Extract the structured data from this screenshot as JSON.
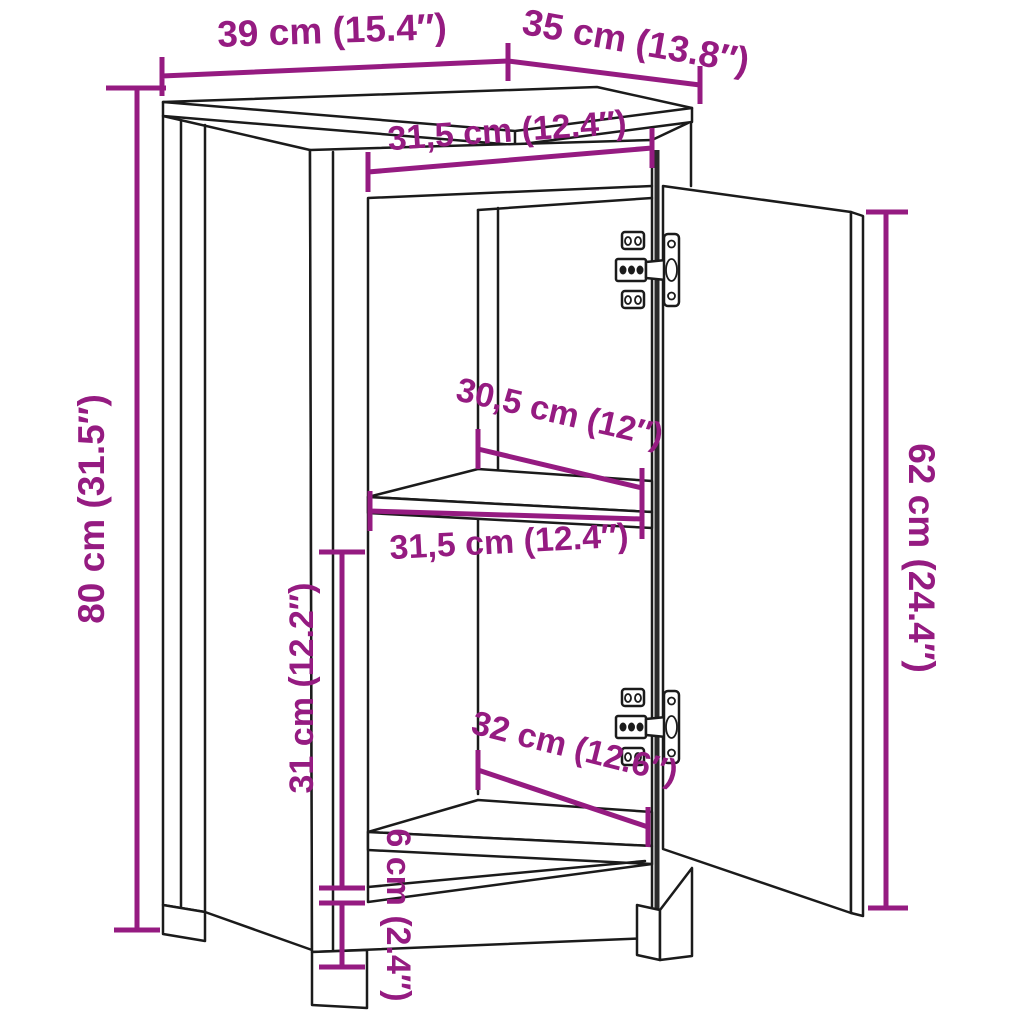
{
  "title": "Cabinet dimensions diagram",
  "diagram": {
    "type": "furniture-dimension-diagram",
    "subject": "two-compartment cabinet with open right-hand door and concealed hinges",
    "colors": {
      "accent": "#951B81",
      "outline": "#1B1B1B",
      "background": "#FFFFFF"
    },
    "dimensions": [
      {
        "id": "top-width",
        "label": "39 cm (15.4″)"
      },
      {
        "id": "top-depth",
        "label": "35 cm (13.8″)"
      },
      {
        "id": "inner-width-top",
        "label": "31,5 cm (12.4″)"
      },
      {
        "id": "total-height",
        "label": "80 cm (31.5″)"
      },
      {
        "id": "shelf-depth",
        "label": "30,5 cm (12″)"
      },
      {
        "id": "inner-width-middle",
        "label": "31,5 cm (12.4″)"
      },
      {
        "id": "door-height",
        "label": "62 cm (24.4″)"
      },
      {
        "id": "inner-height-lower",
        "label": "31 cm (12.2″)"
      },
      {
        "id": "lower-shelf-depth",
        "label": "32 cm (12.6″)"
      },
      {
        "id": "leg-height",
        "label": "6 cm (2.4″)"
      }
    ]
  }
}
